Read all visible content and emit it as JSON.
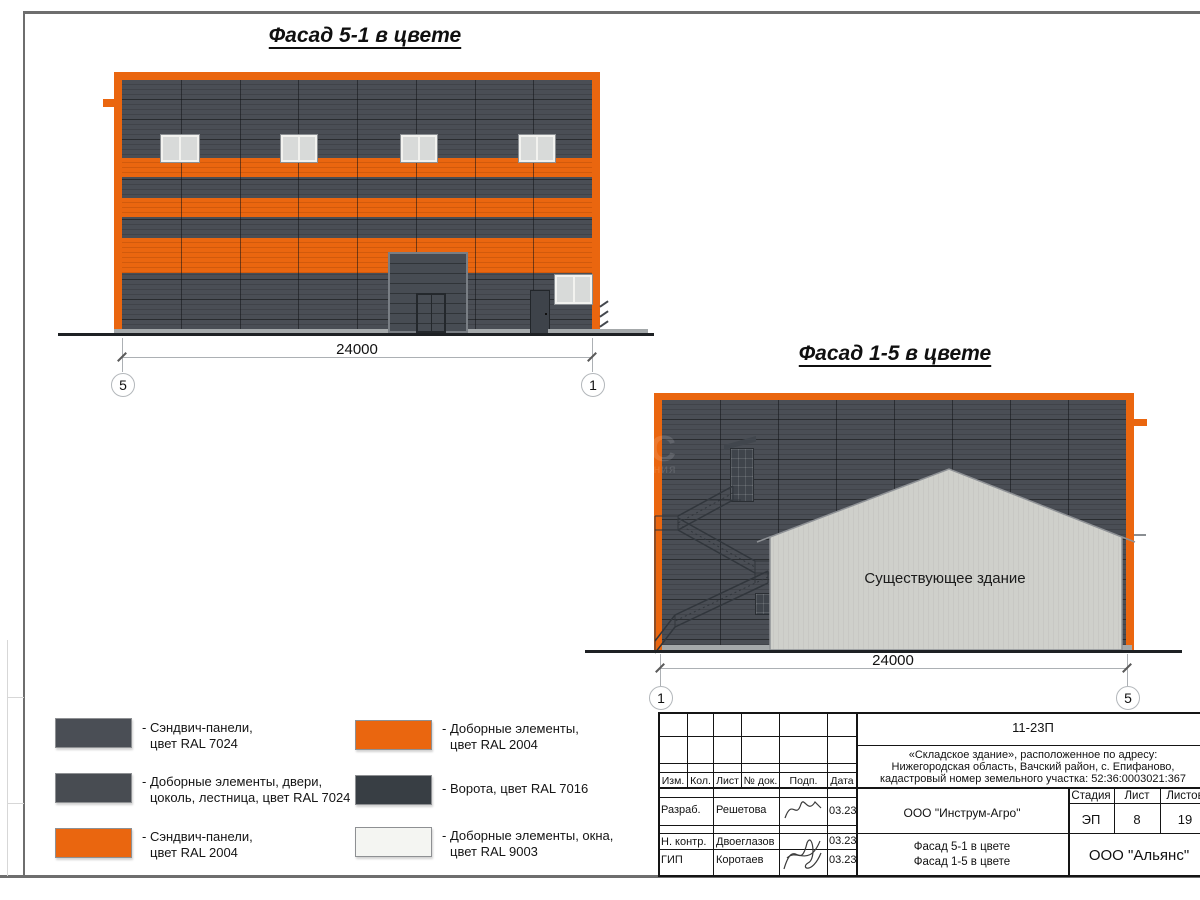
{
  "colors": {
    "accent_orange": "#EA660F",
    "panel_gray_ral7024": "#4A4E55",
    "elements_gray_ral7024": "#484C52",
    "gate_gray_ral7016": "#383E44",
    "window_white_ral9003": "#F4F5F2",
    "existing_building_gray": "#CFD0CB"
  },
  "facade51": {
    "title": "Фасад 5-1 в цвете",
    "dim": "24000",
    "axis_left": "5",
    "axis_right": "1"
  },
  "facade15": {
    "title": "Фасад 1-5 в цвете",
    "dim": "24000",
    "axis_left": "1",
    "axis_right": "5",
    "existing_label": "Существующее здание",
    "watermark_big": "С",
    "watermark_small": "ания"
  },
  "legend": {
    "col1": [
      {
        "color": "#4A4E55",
        "l1": "- Сэндвич-панели,",
        "l2": "цвет RAL 7024"
      },
      {
        "color": "#484C52",
        "l1": "- Доборные элементы, двери,",
        "l2": "цоколь, лестница, цвет RAL 7024"
      },
      {
        "color": "#EA660F",
        "l1": "- Сэндвич-панели,",
        "l2": "цвет RAL 2004"
      }
    ],
    "col2": [
      {
        "color": "#EA660F",
        "l1": "- Доборные элементы,",
        "l2": "цвет RAL 2004"
      },
      {
        "color": "#383E44",
        "l1": "- Ворота, цвет RAL 7016"
      },
      {
        "color": "#F4F5F2",
        "l1": "- Доборные элементы, окна,",
        "l2": "цвет RAL 9003"
      }
    ]
  },
  "titleblock": {
    "doc_number": "11-23П",
    "project_line1": "«Складское здание», расположенное по адресу:",
    "project_line2": "Нижегородская область, Вачский район, с. Епифаново,",
    "project_line3": "кадастровый номер земельного участка: 52:36:0003021:367",
    "col_izm": "Изм.",
    "col_kol": "Кол.",
    "col_list": "Лист",
    "col_doc": "№ док.",
    "col_podp": "Подп.",
    "col_data": "Дата",
    "row1_role": "Разраб.",
    "row1_name": "Решетова",
    "row1_date": "03.23",
    "row2_role": "Н. контр.",
    "row2_name": "Двоеглазов",
    "row2_date": "03.23",
    "row3_role": "ГИП",
    "row3_name": "Коротаев",
    "row3_date": "03.23",
    "org": "ООО \"Инструм-Агро\"",
    "sheet_name_line1": "Фасад 5-1 в цвете",
    "sheet_name_line2": "Фасад 1-5 в цвете",
    "stage_label": "Стадия",
    "list_label": "Лист",
    "listov_label": "Листов",
    "stage": "ЭП",
    "list": "8",
    "listov": "19",
    "company": "ООО \"Альянс\""
  }
}
